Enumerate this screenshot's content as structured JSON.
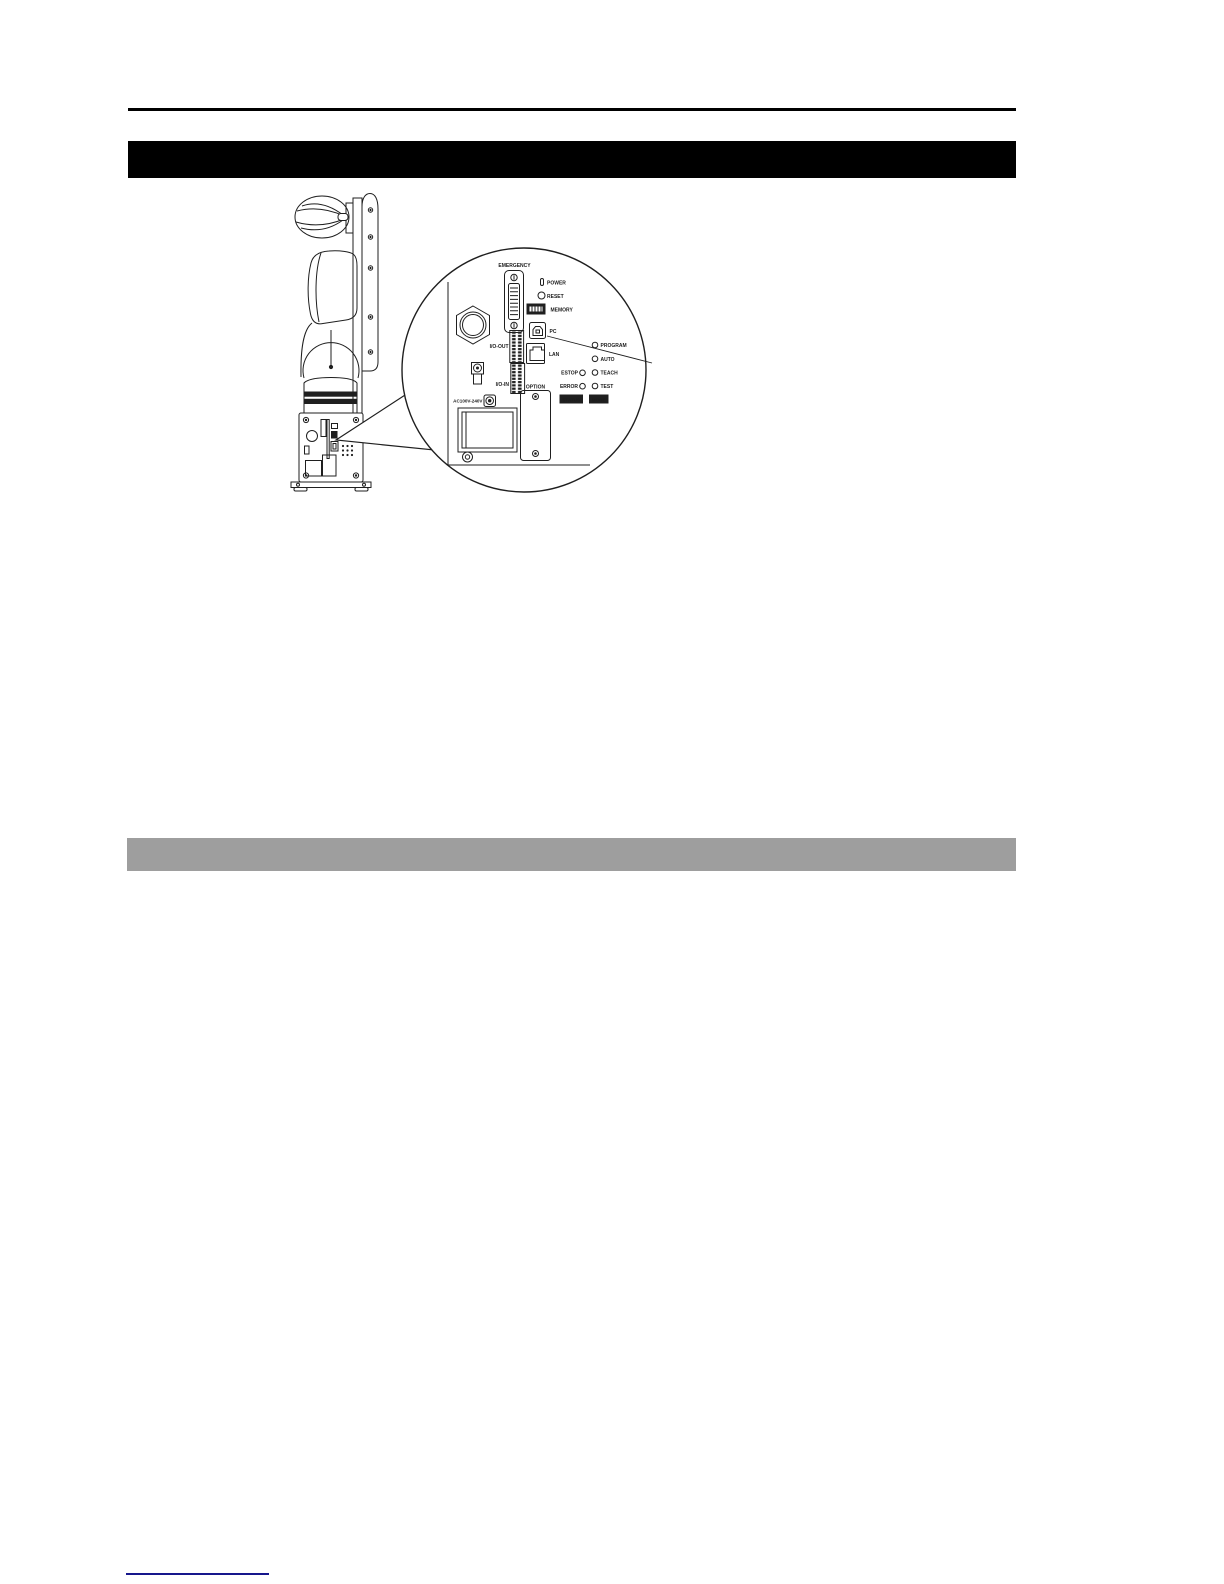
{
  "document": {
    "header_rule_color": "#000000",
    "title_bar": {
      "color": "#000000",
      "text": ""
    },
    "section_bar": {
      "color": "#9e9e9e",
      "text": ""
    },
    "footer_link_color": "#16168c"
  },
  "figure": {
    "line_color": "#1f1f1f",
    "labels": {
      "emergency": "EMERGENCY",
      "power": "POWER",
      "reset": "RESET",
      "memory": "MEMORY",
      "pc": "PC",
      "io_out": "I/O-OUT",
      "lan": "LAN",
      "io_in": "I/O-IN",
      "option": "OPTION",
      "ac_power": "AC100V-240V",
      "estop": "ESTOP",
      "error": "ERROR",
      "program": "PROGRAM",
      "auto": "AUTO",
      "teach": "TEACH",
      "test": "TEST",
      "status": "STATUS",
      "mode": "MODE"
    }
  }
}
